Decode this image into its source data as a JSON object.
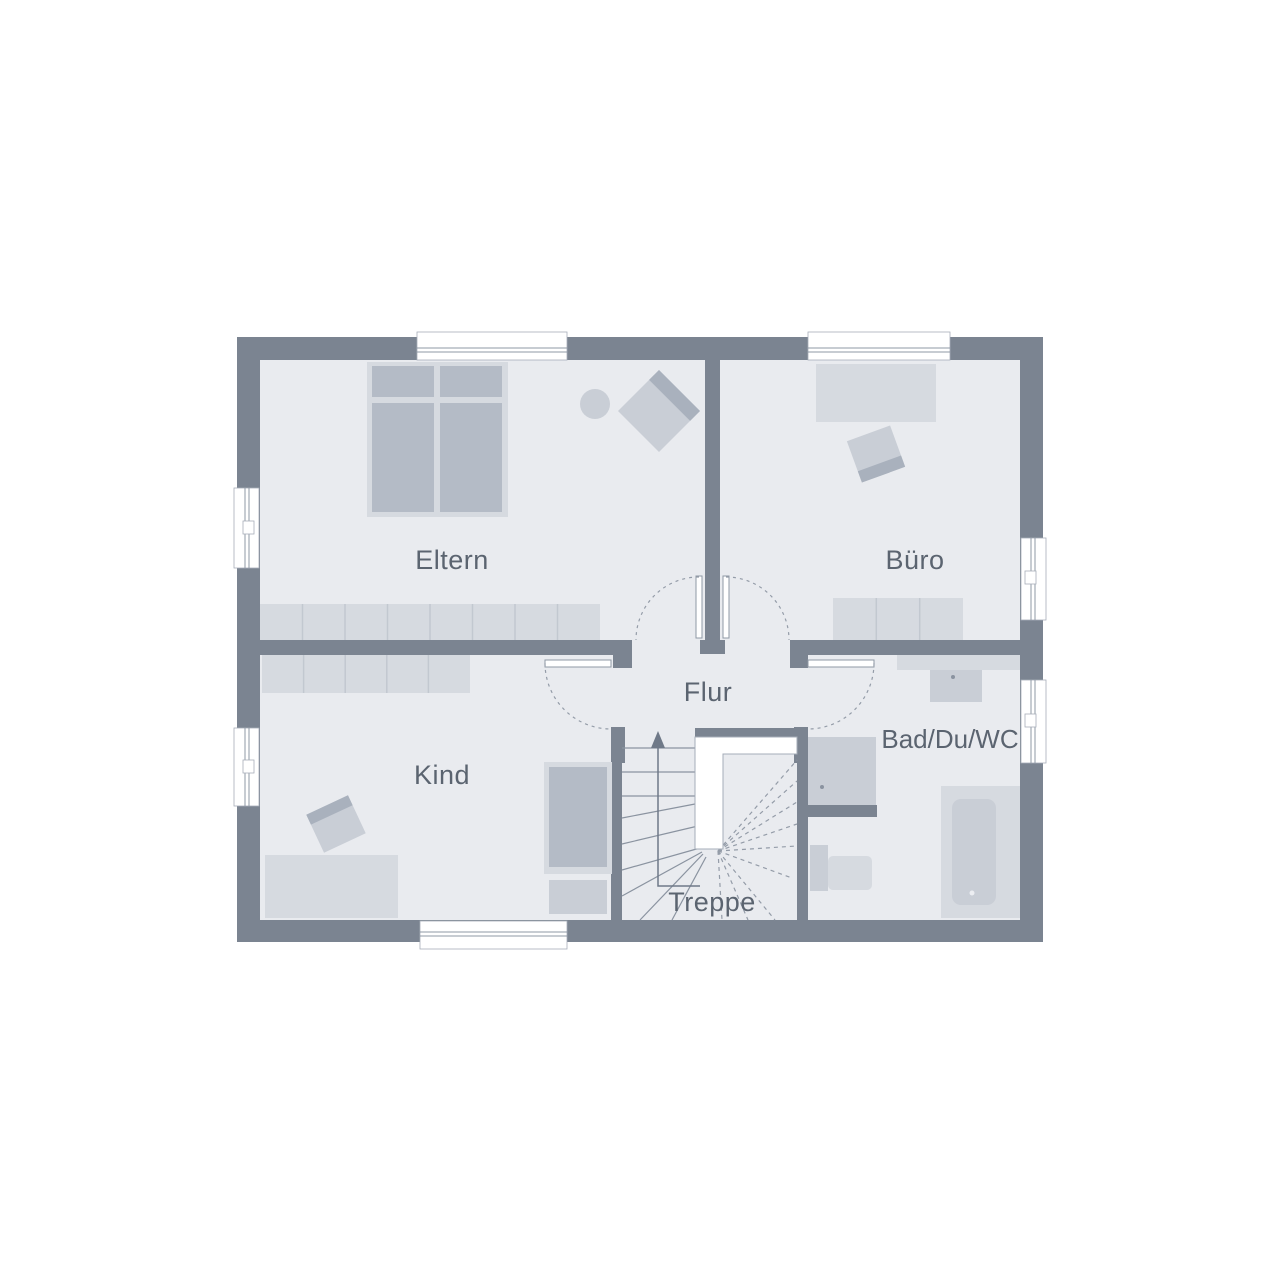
{
  "diagram": {
    "kind": "architectural-floor-plan",
    "floor": "upper-floor"
  },
  "rooms": {
    "eltern": {
      "label": "Eltern"
    },
    "buero": {
      "label": "Büro"
    },
    "kind": {
      "label": "Kind"
    },
    "flur": {
      "label": "Flur"
    },
    "bad": {
      "label": "Bad/Du/WC"
    },
    "treppe": {
      "label": "Treppe"
    }
  },
  "colors": {
    "background": "#ffffff",
    "wall": "#7b8491",
    "floor": "#e9ebef",
    "furniture_light": "#d6dae0",
    "furniture_medium": "#c9ced6",
    "furniture_dark": "#b4bbc6",
    "door_swing_dash": "#949ca8",
    "label_text": "#5b6470",
    "window": "#ffffff"
  }
}
